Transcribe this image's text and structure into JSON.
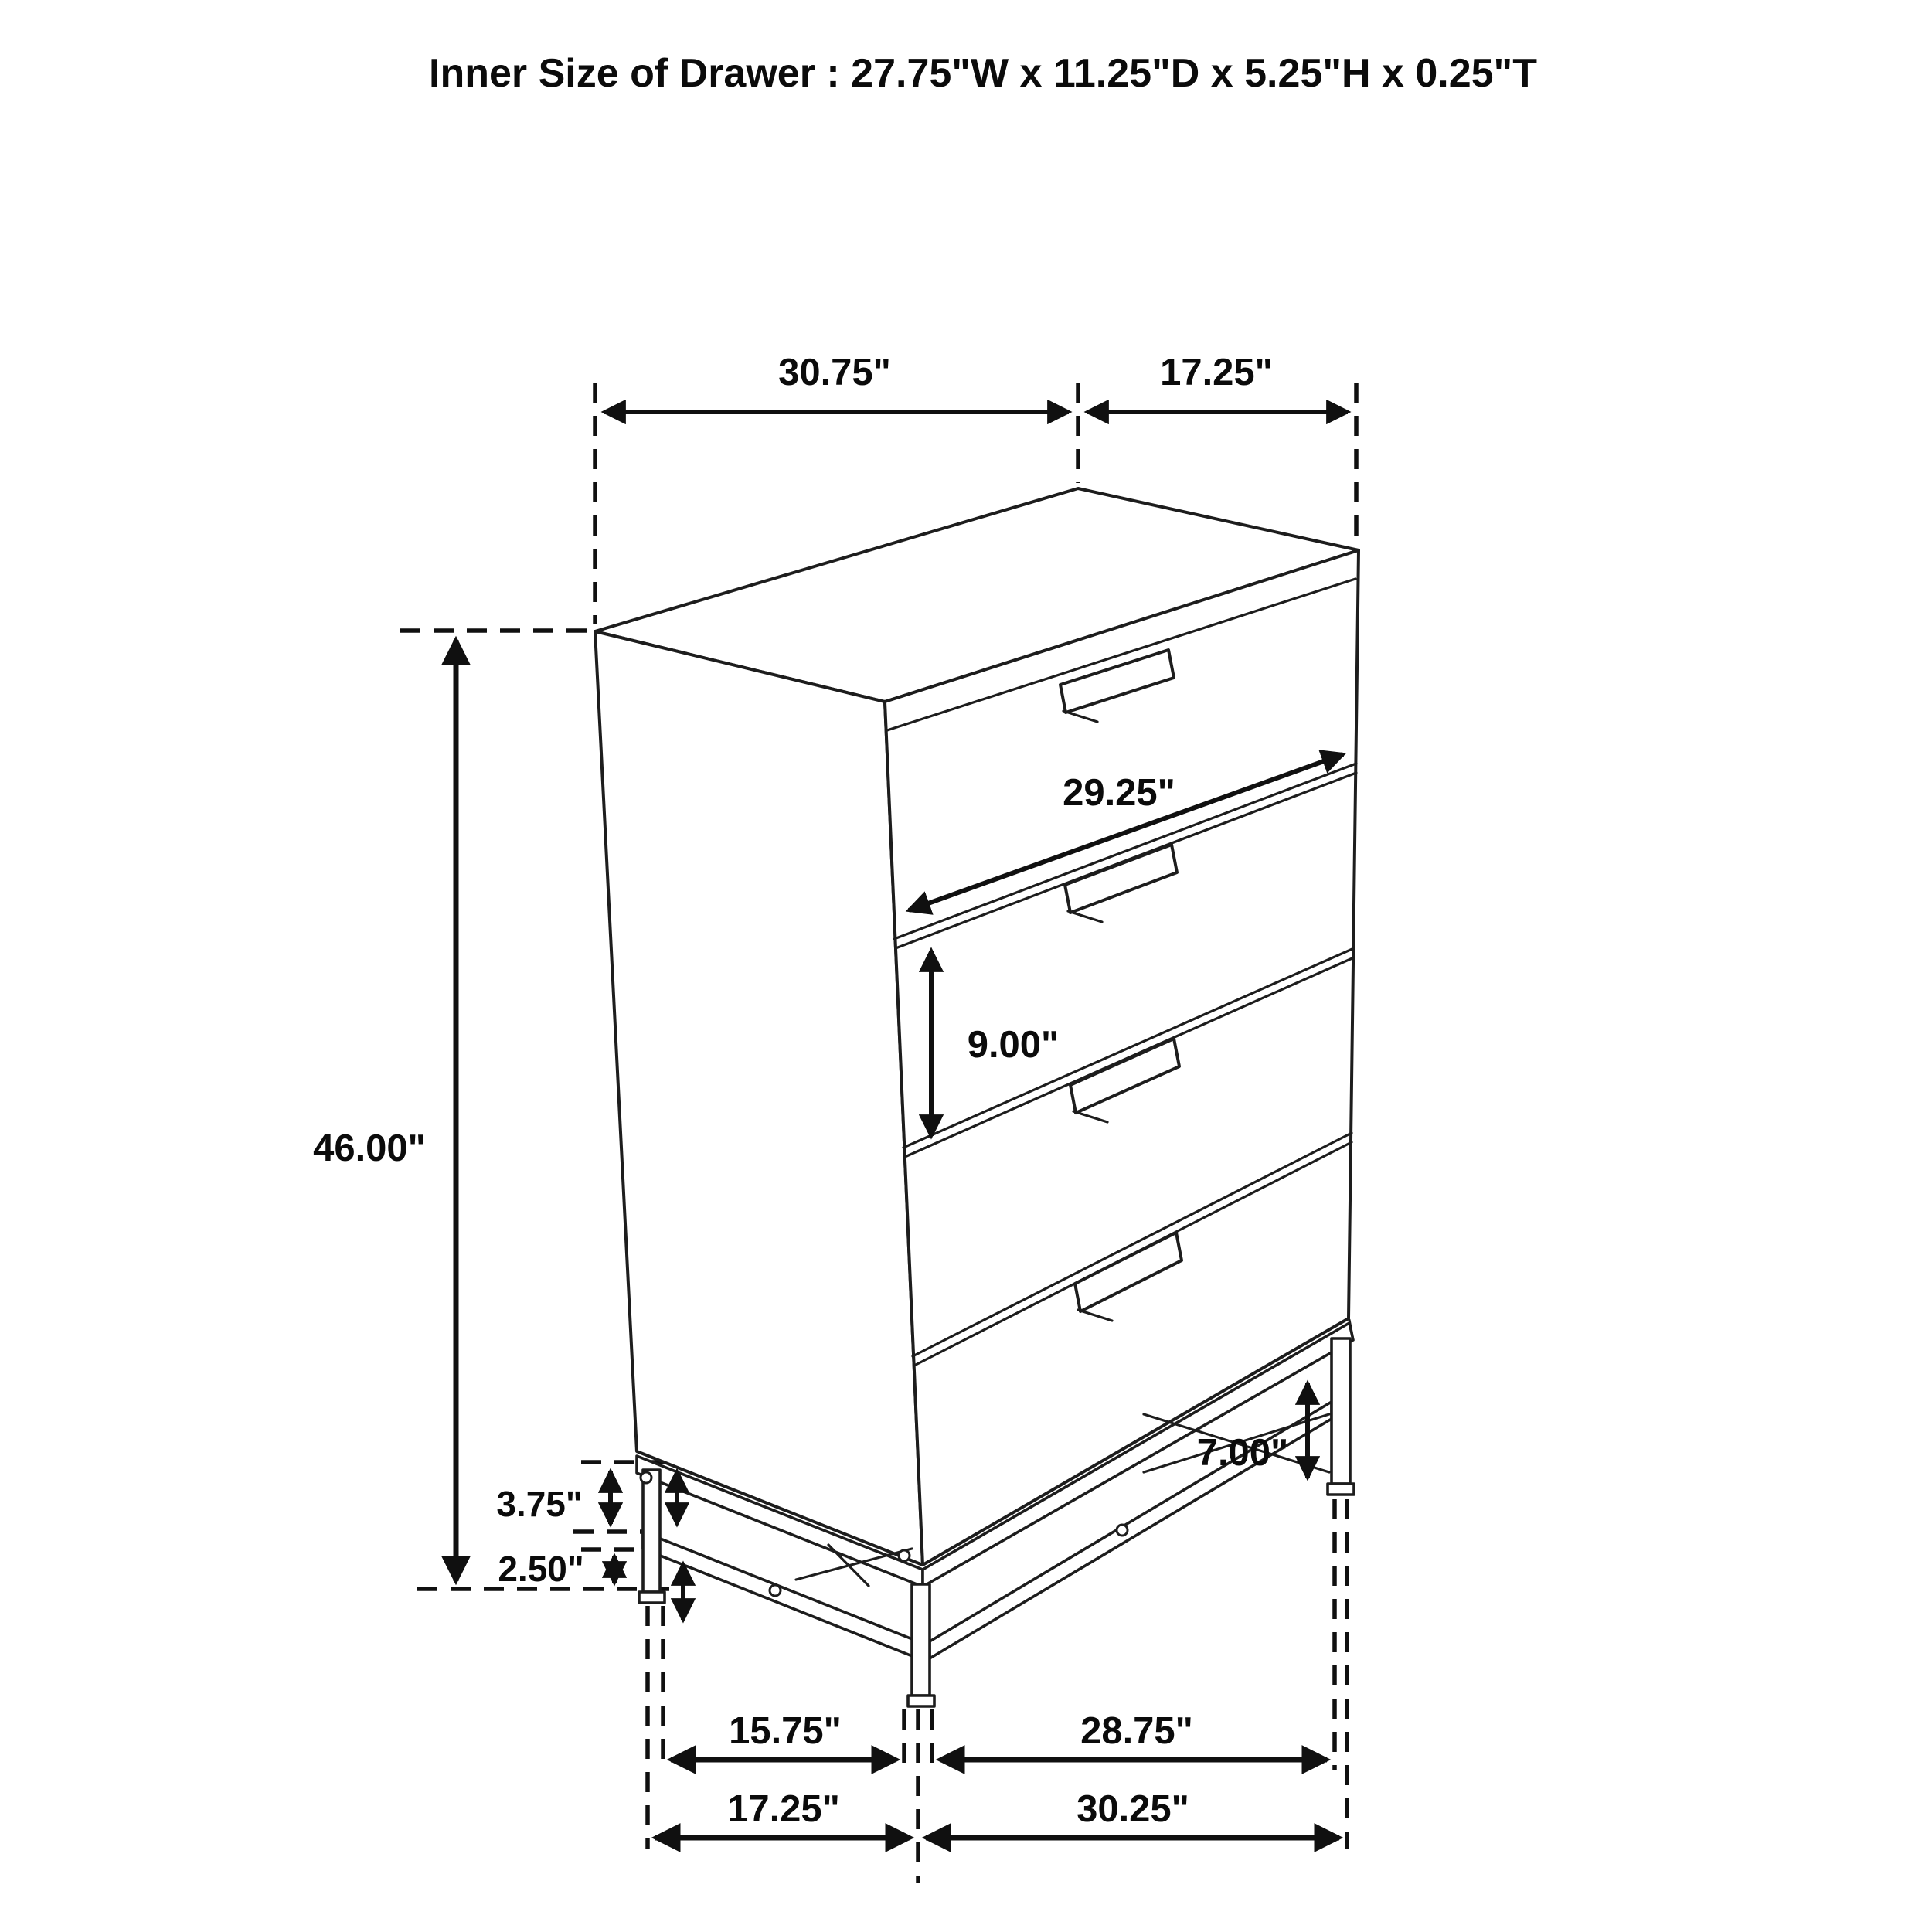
{
  "title": "Inner Size of Drawer : 27.75\"W x 11.25\"D x 5.25\"H x 0.25\"T",
  "dimensions": {
    "top_width": "30.75\"",
    "top_depth": "17.25\"",
    "drawer_width": "29.25\"",
    "drawer_front_height": "9.00\"",
    "overall_height": "46.00\"",
    "leg_clearance": "7.00\"",
    "base_upper_height": "3.75\"",
    "base_lower_height": "2.50\"",
    "floor_inner_depth": "15.75\"",
    "floor_inner_width": "28.75\"",
    "floor_outer_depth": "17.25\"",
    "floor_outer_width": "30.25\""
  },
  "colors": {
    "line": "#1d1d1d",
    "dimension": "#101010",
    "background": "#ffffff"
  }
}
